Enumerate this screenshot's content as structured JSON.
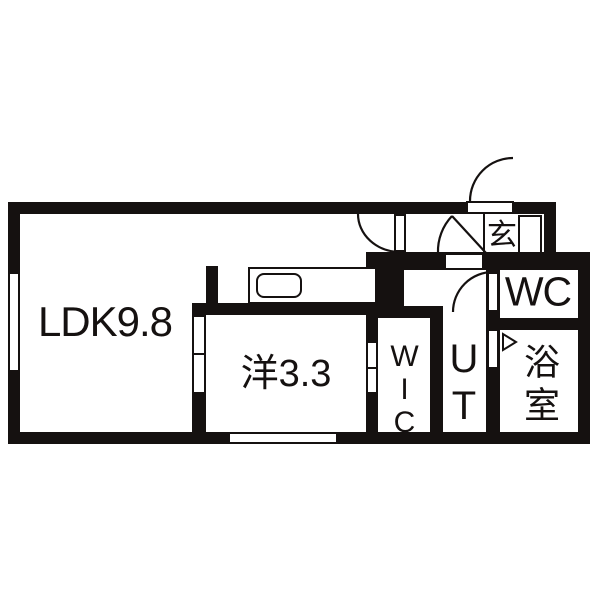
{
  "floorplan": {
    "rooms": [
      {
        "id": "ldk",
        "label": "LDK9.8"
      },
      {
        "id": "bedroom",
        "label": "洋3.3"
      },
      {
        "id": "wic",
        "label": "WIC"
      },
      {
        "id": "ut",
        "label": "UT"
      },
      {
        "id": "wc",
        "label": "WC"
      },
      {
        "id": "bath",
        "label": "浴室"
      },
      {
        "id": "entrance",
        "label": "玄"
      }
    ],
    "symbols": [
      "entrance-swing-door",
      "hall-swing-door",
      "genkan-swing-door",
      "wc-swing-door",
      "bath-folding-door-arrow",
      "kitchen-counter",
      "kitchen-sink",
      "window",
      "sliding-door",
      "shoe-cabinet"
    ],
    "colors": {
      "wall": "#151110",
      "background": "#ffffff"
    }
  }
}
